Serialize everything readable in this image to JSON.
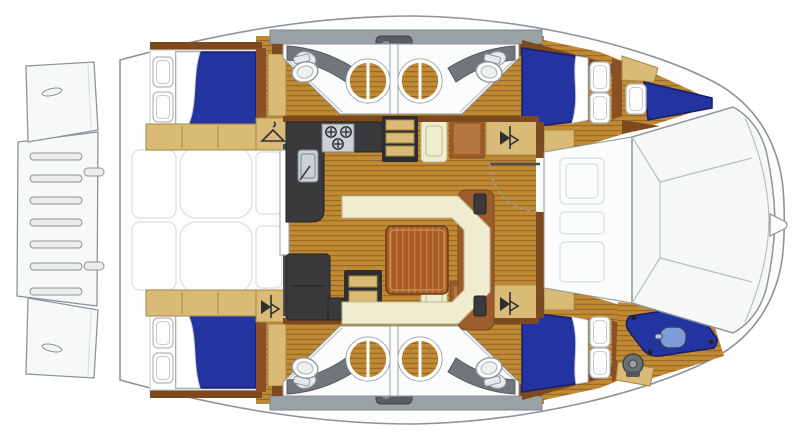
{
  "meta": {
    "title": "Catamaran yacht floor plan, top view, bow to the right",
    "diagram_type": "yacht-floorplan",
    "text_on_image": "none"
  },
  "colors": {
    "outline": "#8d9499",
    "faint": "#dfe3e3",
    "wood_base": "#c08934",
    "wood_stripe": "#996a26",
    "wood_trim": "#7c4a1e",
    "cabinet": "#9c5c2c",
    "cabinet_panel": "#b5773f",
    "tan": "#d9ba77",
    "tan_edge": "#a8893f",
    "cream": "#f0ecd0",
    "cream_edge": "#bfb88e",
    "bed_blue": "#2334a0",
    "bed_blue_dark": "#161d66",
    "charcoal": "#3a3a3c",
    "charcoal_edge": "#222224",
    "steel": "#ccd2d4",
    "gray_deck": "#9aa2a6",
    "white_floor": "#fbfcfc",
    "table_wood": "#a85c28",
    "table_streak": "#c27c42",
    "dinghy_motor": "#7f9cd8"
  },
  "vessel": {
    "type": "catamaran",
    "orientation": "bow-right, stern-left",
    "stern": {
      "swim_platform": {
        "slats": 7,
        "step_tabs": 2
      },
      "transom_platforms": [
        {
          "hull": "top",
          "cleat": true
        },
        {
          "hull": "bottom",
          "cleat": true
        }
      ]
    },
    "aft_cockpit": {
      "furniture": [
        "bench-left",
        "cockpit-table",
        "bench-right"
      ],
      "sliding_door": true
    },
    "salon": {
      "galley": {
        "stove_burners": 3,
        "sink": true,
        "counters": [
          "l-counter",
          "lower-cabinet"
        ]
      },
      "dinette": {
        "settee": "u-shaped",
        "table": true,
        "speaker_blocks": 2
      },
      "companionways": [
        {
          "hull": "top",
          "treads": 3
        },
        {
          "hull": "bottom",
          "treads": 3
        }
      ],
      "cabinets": [
        "wood-cabinet-fwd-top",
        "wood-cabinet-fwd-bottom",
        "cream-unit-top",
        "cream-unit-bottom"
      ],
      "wardrobes": [
        {
          "location": "aft-top-hull",
          "icon": "hanger-icon"
        },
        {
          "location": "aft-bottom-hull",
          "icon": "hanging-locker-icon"
        },
        {
          "location": "fwd-top",
          "icon": "hanging-locker-icon"
        },
        {
          "location": "fwd-bottom",
          "icon": "hanging-locker-icon"
        }
      ],
      "forward_door": {
        "swing_arc": "dashed"
      }
    },
    "hulls": [
      {
        "id": "top-hull",
        "aft_cabin": {
          "berth": "double",
          "mattress": "blue",
          "pillows": 2,
          "shelf": "tan"
        },
        "heads": [
          {
            "position": "aft",
            "toilet": true,
            "shower_circle": true,
            "vanity_sink": true
          },
          {
            "position": "forward",
            "toilet": true,
            "shower_circle": true,
            "vanity_sink": true
          }
        ],
        "deck_hatch_units": 1,
        "forward_cabin": {
          "berth": "double",
          "mattress": "blue",
          "pillows": 2
        },
        "bow": {
          "crew_berth": {
            "mattress": "blue",
            "pillows": 1
          }
        }
      },
      {
        "id": "bottom-hull",
        "aft_cabin": {
          "berth": "double",
          "mattress": "blue",
          "pillows": 2,
          "shelf": "tan"
        },
        "heads": [
          {
            "position": "aft",
            "toilet": true,
            "shower_circle": true,
            "vanity_sink": true
          },
          {
            "position": "forward",
            "toilet": true,
            "shower_circle": true,
            "vanity_sink": true
          }
        ],
        "deck_hatch_units": 1,
        "forward_cabin": {
          "berth": "double",
          "mattress": "blue",
          "pillows": 2
        },
        "bow": {
          "dinghy": {
            "color": "blue",
            "outboard_motor": true,
            "lashing_points": 4
          },
          "windlass": true
        }
      }
    ],
    "forward_cockpit": {
      "faint_hatches": 3
    },
    "foredeck": {
      "panel_seams": true,
      "bow_bridle_tip": true
    }
  }
}
